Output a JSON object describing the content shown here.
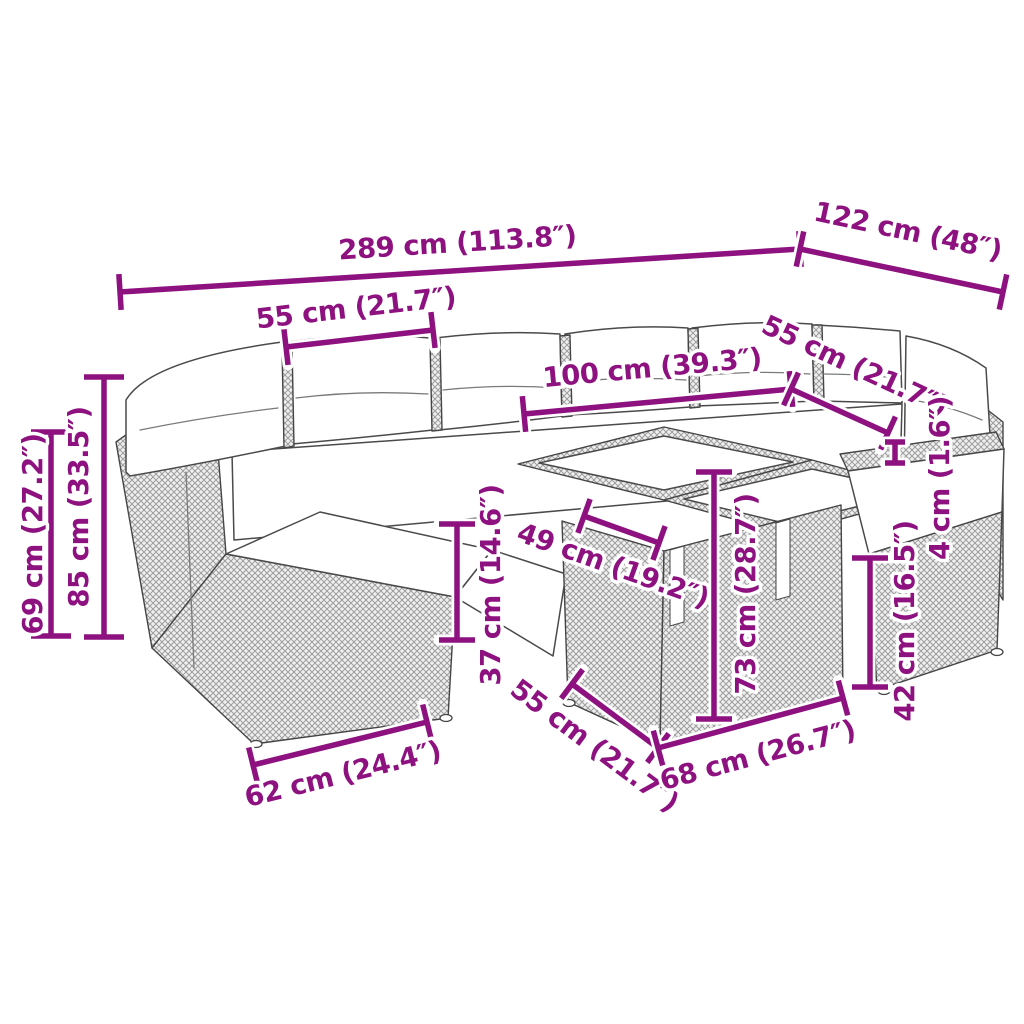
{
  "figure": {
    "kind": "product-dimension-diagram",
    "subject": "rattan garden sofa set with cube tables and chair",
    "accent_color": "#8E1180",
    "sketch_outline_color": "#454545",
    "dimensions": [
      {
        "id": "overall-width",
        "label": "289 cm (113.8″)",
        "x1": 120,
        "y1": 292,
        "x2": 800,
        "y2": 249,
        "lx": 458,
        "ly": 252,
        "rot": -3.6
      },
      {
        "id": "back-depth",
        "label": "122 cm (48″)",
        "x1": 800,
        "y1": 249,
        "x2": 1003,
        "y2": 292,
        "lx": 906,
        "ly": 240,
        "rot": 12
      },
      {
        "id": "left-seat-width",
        "label": "55 cm (21.7″)",
        "x1": 286,
        "y1": 347,
        "x2": 433,
        "y2": 330,
        "lx": 357,
        "ly": 317,
        "rot": -6.6
      },
      {
        "id": "back-section-width",
        "label": "100 cm (39.3″)",
        "x1": 524,
        "y1": 414,
        "x2": 791,
        "y2": 389,
        "lx": 653,
        "ly": 377,
        "rot": -5.3
      },
      {
        "id": "right-seat-width",
        "label": "55 cm (21.7″)",
        "x1": 791,
        "y1": 389,
        "x2": 888,
        "y2": 433,
        "lx": 851,
        "ly": 374,
        "rot": 24.9
      },
      {
        "id": "seat-height",
        "label": "69 cm (27.2″)",
        "x1": 51,
        "y1": 432,
        "x2": 51,
        "y2": 636,
        "lx": 42,
        "ly": 534,
        "rot": -90,
        "tick": 20
      },
      {
        "id": "back-height",
        "label": "85 cm (33.5″)",
        "x1": 104,
        "y1": 377,
        "x2": 104,
        "y2": 637,
        "lx": 88,
        "ly": 507,
        "rot": -90,
        "tick": 20
      },
      {
        "id": "tabletop-slide",
        "label": "49 cm (19.2″)",
        "x1": 584,
        "y1": 516,
        "x2": 659,
        "y2": 543,
        "lx": 610,
        "ly": 574,
        "rot": 19.7
      },
      {
        "id": "seat-frame-height",
        "label": "37 cm (14.6″)",
        "x1": 457,
        "y1": 524,
        "x2": 457,
        "y2": 640,
        "lx": 500,
        "ly": 585,
        "rot": -90
      },
      {
        "id": "table-height",
        "label": "73 cm (28.7″)",
        "x1": 714,
        "y1": 472,
        "x2": 714,
        "y2": 719,
        "lx": 755,
        "ly": 594,
        "rot": -90
      },
      {
        "id": "armrest-thickness",
        "label": "4 cm (1.6″)",
        "x1": 895,
        "y1": 442,
        "x2": 895,
        "y2": 463,
        "lx": 949,
        "ly": 478,
        "rot": -90,
        "tick": 10
      },
      {
        "id": "chair-frame-height",
        "label": "42 cm (16.5″)",
        "x1": 870,
        "y1": 558,
        "x2": 870,
        "y2": 687,
        "lx": 914,
        "ly": 621,
        "rot": -90
      },
      {
        "id": "seat-depth",
        "label": "62 cm (24.4″)",
        "x1": 253,
        "y1": 765,
        "x2": 427,
        "y2": 722,
        "lx": 345,
        "ly": 783,
        "rot": -13.9
      },
      {
        "id": "table-width",
        "label": "55 cm (21.7″)",
        "x1": 572,
        "y1": 684,
        "x2": 658,
        "y2": 748,
        "lx": 589,
        "ly": 753,
        "rot": 36.7
      },
      {
        "id": "table-depth",
        "label": "68 cm (26.7″)",
        "x1": 658,
        "y1": 748,
        "x2": 843,
        "y2": 698,
        "lx": 760,
        "ly": 764,
        "rot": -15.1
      }
    ]
  }
}
